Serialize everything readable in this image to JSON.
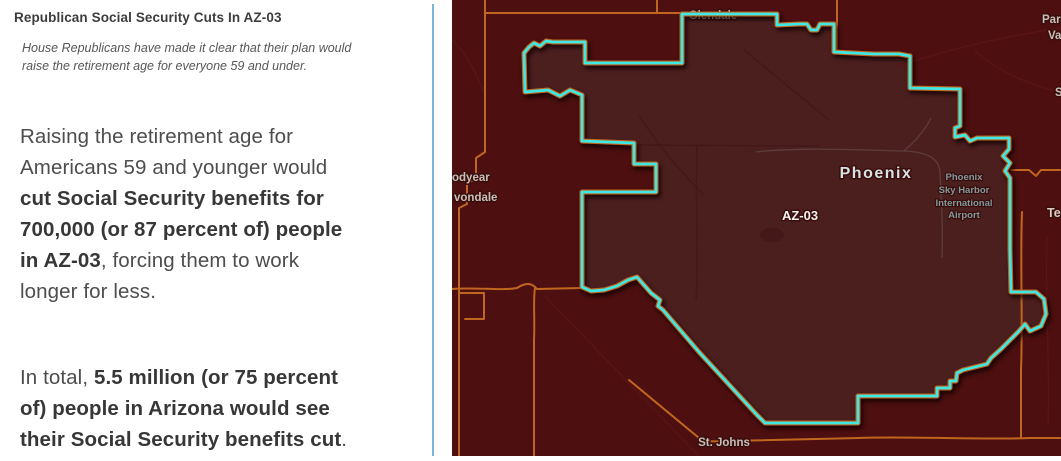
{
  "panel": {
    "title": "Republican Social Security Cuts In AZ-03",
    "subtitle": "House Republicans have made it clear that their plan would\nraise the retirement age for everyone 59 and under.",
    "paragraph1": {
      "segments": [
        {
          "text": "Raising the retirement age for\nAmericans 59 and younger would\n",
          "bold": false
        },
        {
          "text": "cut Social Security benefits for\n700,000 (or 87 percent of) people\nin AZ-03",
          "bold": true
        },
        {
          "text": ", forcing them to work\nlonger for less.",
          "bold": false
        }
      ]
    },
    "paragraph2": {
      "segments": [
        {
          "text": "In total, ",
          "bold": false
        },
        {
          "text": "5.5 million (or 75 percent\nof) people in Arizona would see\ntheir Social Security benefits cut",
          "bold": true
        },
        {
          "text": ".",
          "bold": false
        }
      ]
    }
  },
  "map": {
    "district_label": "AZ-03",
    "colors": {
      "map_background": "#4d0f0f",
      "district_fill": "#4c1f1f",
      "district_outline": "#3ee8e4",
      "road": "#c1661f",
      "city_label": "#c7c0b7",
      "major_city_label": "#d6e3e4",
      "district_label": "#f4f2ef",
      "poi_label": "#7f9a99",
      "divider": "#7eb3d8"
    },
    "labels": [
      {
        "name": "label-glendale",
        "text": "Glendale",
        "x": 714,
        "y": 19,
        "cls": "city",
        "anchor": "middle",
        "layer": "under"
      },
      {
        "name": "label-goodyear-partial",
        "text": "odyear",
        "x": 453,
        "y": 181,
        "cls": "city",
        "anchor": "start"
      },
      {
        "name": "label-avondale-partial",
        "text": "vondale",
        "x": 455,
        "y": 201,
        "cls": "city",
        "anchor": "start"
      },
      {
        "name": "label-phoenix",
        "text": "Phoenix",
        "x": 877,
        "y": 178,
        "cls": "city-major",
        "anchor": "middle"
      },
      {
        "name": "label-district-az03",
        "text": "AZ-03",
        "x": 801,
        "y": 220,
        "cls": "district-lbl",
        "anchor": "middle"
      },
      {
        "name": "label-airport-line1",
        "text": "Phoenix",
        "x": 965,
        "y": 180,
        "cls": "poi",
        "anchor": "middle"
      },
      {
        "name": "label-airport-line2",
        "text": "Sky Harbor",
        "x": 965,
        "y": 193,
        "cls": "poi",
        "anchor": "middle"
      },
      {
        "name": "label-airport-line3",
        "text": "International",
        "x": 965,
        "y": 206,
        "cls": "poi",
        "anchor": "middle"
      },
      {
        "name": "label-airport-line4",
        "text": "Airport",
        "x": 965,
        "y": 218,
        "cls": "poi",
        "anchor": "middle"
      },
      {
        "name": "label-st-johns",
        "text": "St. Johns",
        "x": 725,
        "y": 446,
        "cls": "city",
        "anchor": "middle"
      },
      {
        "name": "label-paradise-partial1",
        "text": "Para",
        "x": 1043,
        "y": 23,
        "cls": "city",
        "anchor": "start"
      },
      {
        "name": "label-paradise-partial2",
        "text": "Va",
        "x": 1049,
        "y": 39,
        "cls": "city",
        "anchor": "start"
      },
      {
        "name": "label-s-partial",
        "text": "S",
        "x": 1056,
        "y": 96,
        "cls": "city",
        "anchor": "start"
      },
      {
        "name": "label-tempe-partial",
        "text": "Te",
        "x": 1048,
        "y": 217,
        "cls": "city-warm",
        "anchor": "start"
      }
    ]
  }
}
